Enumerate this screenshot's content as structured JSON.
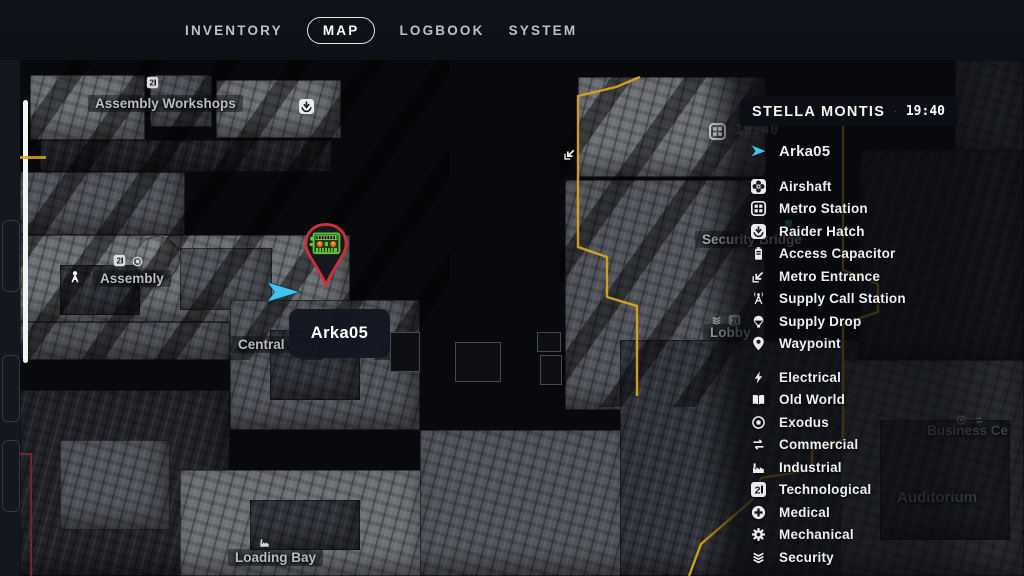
{
  "nav": {
    "items": [
      {
        "label": "INVENTORY",
        "active": false
      },
      {
        "label": "MAP",
        "active": true
      },
      {
        "label": "LOGBOOK",
        "active": false
      },
      {
        "label": "SYSTEM",
        "active": false
      }
    ]
  },
  "legend": {
    "title": "STELLA MONTIS",
    "time": "19:40",
    "tracked": {
      "icon": "player-arrow",
      "label": "Arka05"
    },
    "groups": [
      {
        "items": [
          {
            "icon": "airshaft",
            "label": "Airshaft"
          },
          {
            "icon": "metro-station",
            "label": "Metro Station"
          },
          {
            "icon": "raider-hatch",
            "label": "Raider Hatch"
          },
          {
            "icon": "access-capacitor",
            "label": "Access Capacitor"
          },
          {
            "icon": "metro-entrance",
            "label": "Metro Entrance"
          },
          {
            "icon": "supply-call-station",
            "label": "Supply Call Station"
          },
          {
            "icon": "supply-drop",
            "label": "Supply Drop"
          },
          {
            "icon": "waypoint",
            "label": "Waypoint"
          }
        ]
      },
      {
        "items": [
          {
            "icon": "electrical",
            "label": "Electrical"
          },
          {
            "icon": "old-world",
            "label": "Old World"
          },
          {
            "icon": "exodus",
            "label": "Exodus"
          },
          {
            "icon": "commercial",
            "label": "Commercial"
          },
          {
            "icon": "industrial",
            "label": "Industrial"
          },
          {
            "icon": "technological",
            "label": "Technological"
          },
          {
            "icon": "medical",
            "label": "Medical"
          },
          {
            "icon": "mechanical",
            "label": "Mechanical"
          },
          {
            "icon": "security",
            "label": "Security"
          }
        ]
      }
    ]
  },
  "map": {
    "tooltip": {
      "label": "Arka05"
    },
    "faint_time": "19:40",
    "labels": [
      {
        "text": "Assembly Workshops"
      },
      {
        "text": "Assembly"
      },
      {
        "text": "Central Co"
      },
      {
        "text": "Loading Bay"
      },
      {
        "text": "Security Bridge"
      },
      {
        "text": "Lobby"
      },
      {
        "text": "Business Ce"
      },
      {
        "text": "Auditorium"
      }
    ],
    "colors": {
      "boundary": "#d9a41f",
      "player_arrow": "#3fc6ee",
      "pin_ring": "#cd3038",
      "pin_robot": "#5fc23c",
      "tooltip_bg": "#131722"
    }
  }
}
